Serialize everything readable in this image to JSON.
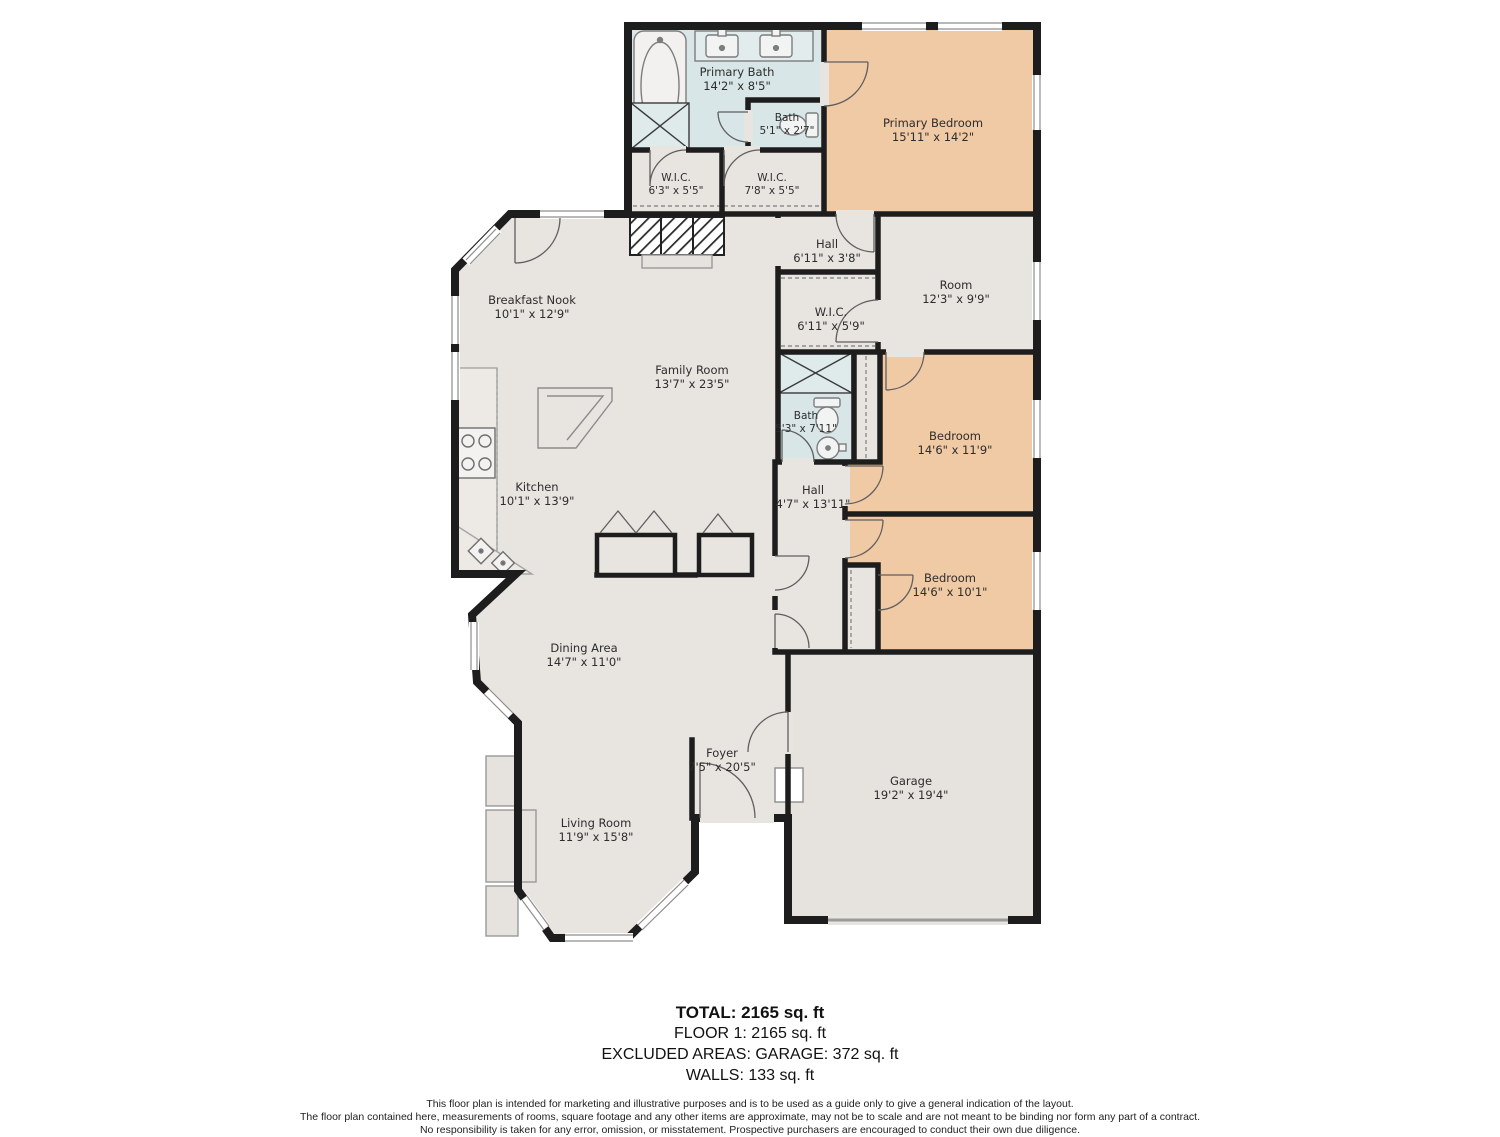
{
  "colors": {
    "wall": "#1d1d1d",
    "floor": "#e8e4e0",
    "bedroom_fill": "#f0c9a5",
    "bath_fill": "#d8e6e7",
    "label_text": "#2d2d2d"
  },
  "floorplan": {
    "rooms": [
      {
        "id": "primary-bath",
        "name": "Primary Bath",
        "dims": "14'2\" x 8'5\""
      },
      {
        "id": "bath-small",
        "name": "Bath",
        "dims": "5'1\" x 2'7\""
      },
      {
        "id": "primary-bedroom",
        "name": "Primary Bedroom",
        "dims": "15'11\" x 14'2\""
      },
      {
        "id": "wic-1",
        "name": "W.I.C.",
        "dims": "6'3\" x 5'5\""
      },
      {
        "id": "wic-2",
        "name": "W.I.C.",
        "dims": "7'8\" x 5'5\""
      },
      {
        "id": "hall-upper",
        "name": "Hall",
        "dims": "6'11\" x 3'8\""
      },
      {
        "id": "room",
        "name": "Room",
        "dims": "12'3\" x 9'9\""
      },
      {
        "id": "breakfast-nook",
        "name": "Breakfast Nook",
        "dims": "10'1\" x 12'9\""
      },
      {
        "id": "wic-3",
        "name": "W.I.C.",
        "dims": "6'11\" x 5'9\""
      },
      {
        "id": "family-room",
        "name": "Family Room",
        "dims": "13'7\" x 23'5\""
      },
      {
        "id": "bath-2",
        "name": "Bath",
        "dims": "5'3\" x 7'11\""
      },
      {
        "id": "bedroom-1",
        "name": "Bedroom",
        "dims": "14'6\" x 11'9\""
      },
      {
        "id": "kitchen",
        "name": "Kitchen",
        "dims": "10'1\" x 13'9\""
      },
      {
        "id": "hall-lower",
        "name": "Hall",
        "dims": "4'7\" x 13'11\""
      },
      {
        "id": "bedroom-2",
        "name": "Bedroom",
        "dims": "14'6\" x 10'1\""
      },
      {
        "id": "dining-area",
        "name": "Dining Area",
        "dims": "14'7\" x 11'0\""
      },
      {
        "id": "foyer",
        "name": "Foyer",
        "dims": "7'5\" x 20'5\""
      },
      {
        "id": "garage",
        "name": "Garage",
        "dims": "19'2\" x 19'4\""
      },
      {
        "id": "living-room",
        "name": "Living Room",
        "dims": "11'9\" x 15'8\""
      }
    ]
  },
  "summary": {
    "total": "TOTAL: 2165 sq. ft",
    "floor1": "FLOOR 1: 2165 sq. ft",
    "excluded_areas": "EXCLUDED AREAS: GARAGE: 372 sq. ft",
    "walls": "WALLS: 133 sq. ft"
  },
  "disclaimer": {
    "line1": "This floor plan is intended for marketing and illustrative purposes and is to be used as a guide only to give a general indication of the layout.",
    "line2": "The floor plan contained here, measurements of rooms, square footage and any other items are approximate, may not be to scale and are not meant to be binding nor form any part of a contract.",
    "line3": "No responsibility is taken for any error, omission, or misstatement. Prospective purchasers are encouraged to conduct their own due diligence."
  }
}
